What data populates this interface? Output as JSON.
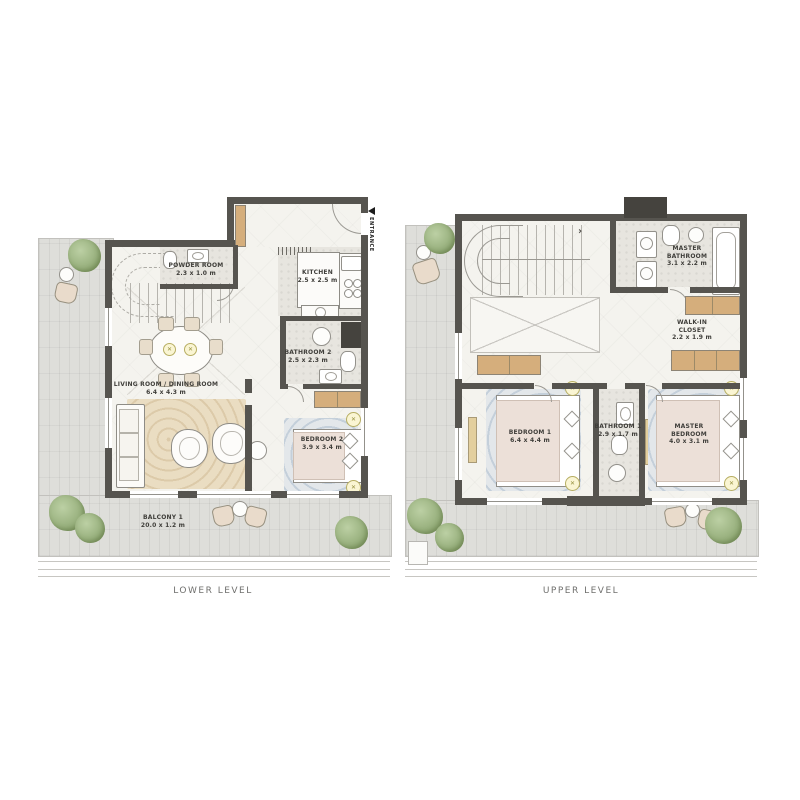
{
  "colors": {
    "wall": "#56544f",
    "floor": "#f4f3ee",
    "terrace": "#dededa",
    "wet_floor": "#e7e5df",
    "wood": "#d5ae7c",
    "rug_beige": "#ead dc2",
    "rug_blue": "#e3e7ea",
    "tree": "#91aa76",
    "label_text": "#3f3e3a"
  },
  "lower": {
    "caption": "LOWER LEVEL",
    "entrance": "ENTRANCE",
    "rooms": {
      "powder": {
        "name": "POWDER ROOM",
        "dims": "2.3 x 1.0 m"
      },
      "kitchen": {
        "name": "KITCHEN",
        "dims": "2.5 x 2.5 m"
      },
      "bath2": {
        "name": "BATHROOM 2",
        "dims": "2.5 x 2.3 m"
      },
      "living": {
        "name": "LIVING ROOM / DINING ROOM",
        "dims": "6.4 x 4.3 m"
      },
      "bed2": {
        "name": "BEDROOM 2",
        "dims": "3.9 x 3.4 m"
      },
      "balcony": {
        "name": "BALCONY 1",
        "dims": "20.0 x 1.2 m"
      }
    }
  },
  "upper": {
    "caption": "UPPER LEVEL",
    "rooms": {
      "masterbath": {
        "name": "MASTER BATHROOM",
        "dims": "3.1 x 2.2 m"
      },
      "closet": {
        "name": "WALK-IN CLOSET",
        "dims": "2.2 x 1.9 m"
      },
      "bed1": {
        "name": "BEDROOM 1",
        "dims": "6.4 x 4.4 m"
      },
      "bath1": {
        "name": "BATHROOM 1",
        "dims": "2.9 x 1.7 m"
      },
      "masterbed": {
        "name": "MASTER BEDROOM",
        "dims": "4.0 x 3.1 m"
      }
    }
  }
}
